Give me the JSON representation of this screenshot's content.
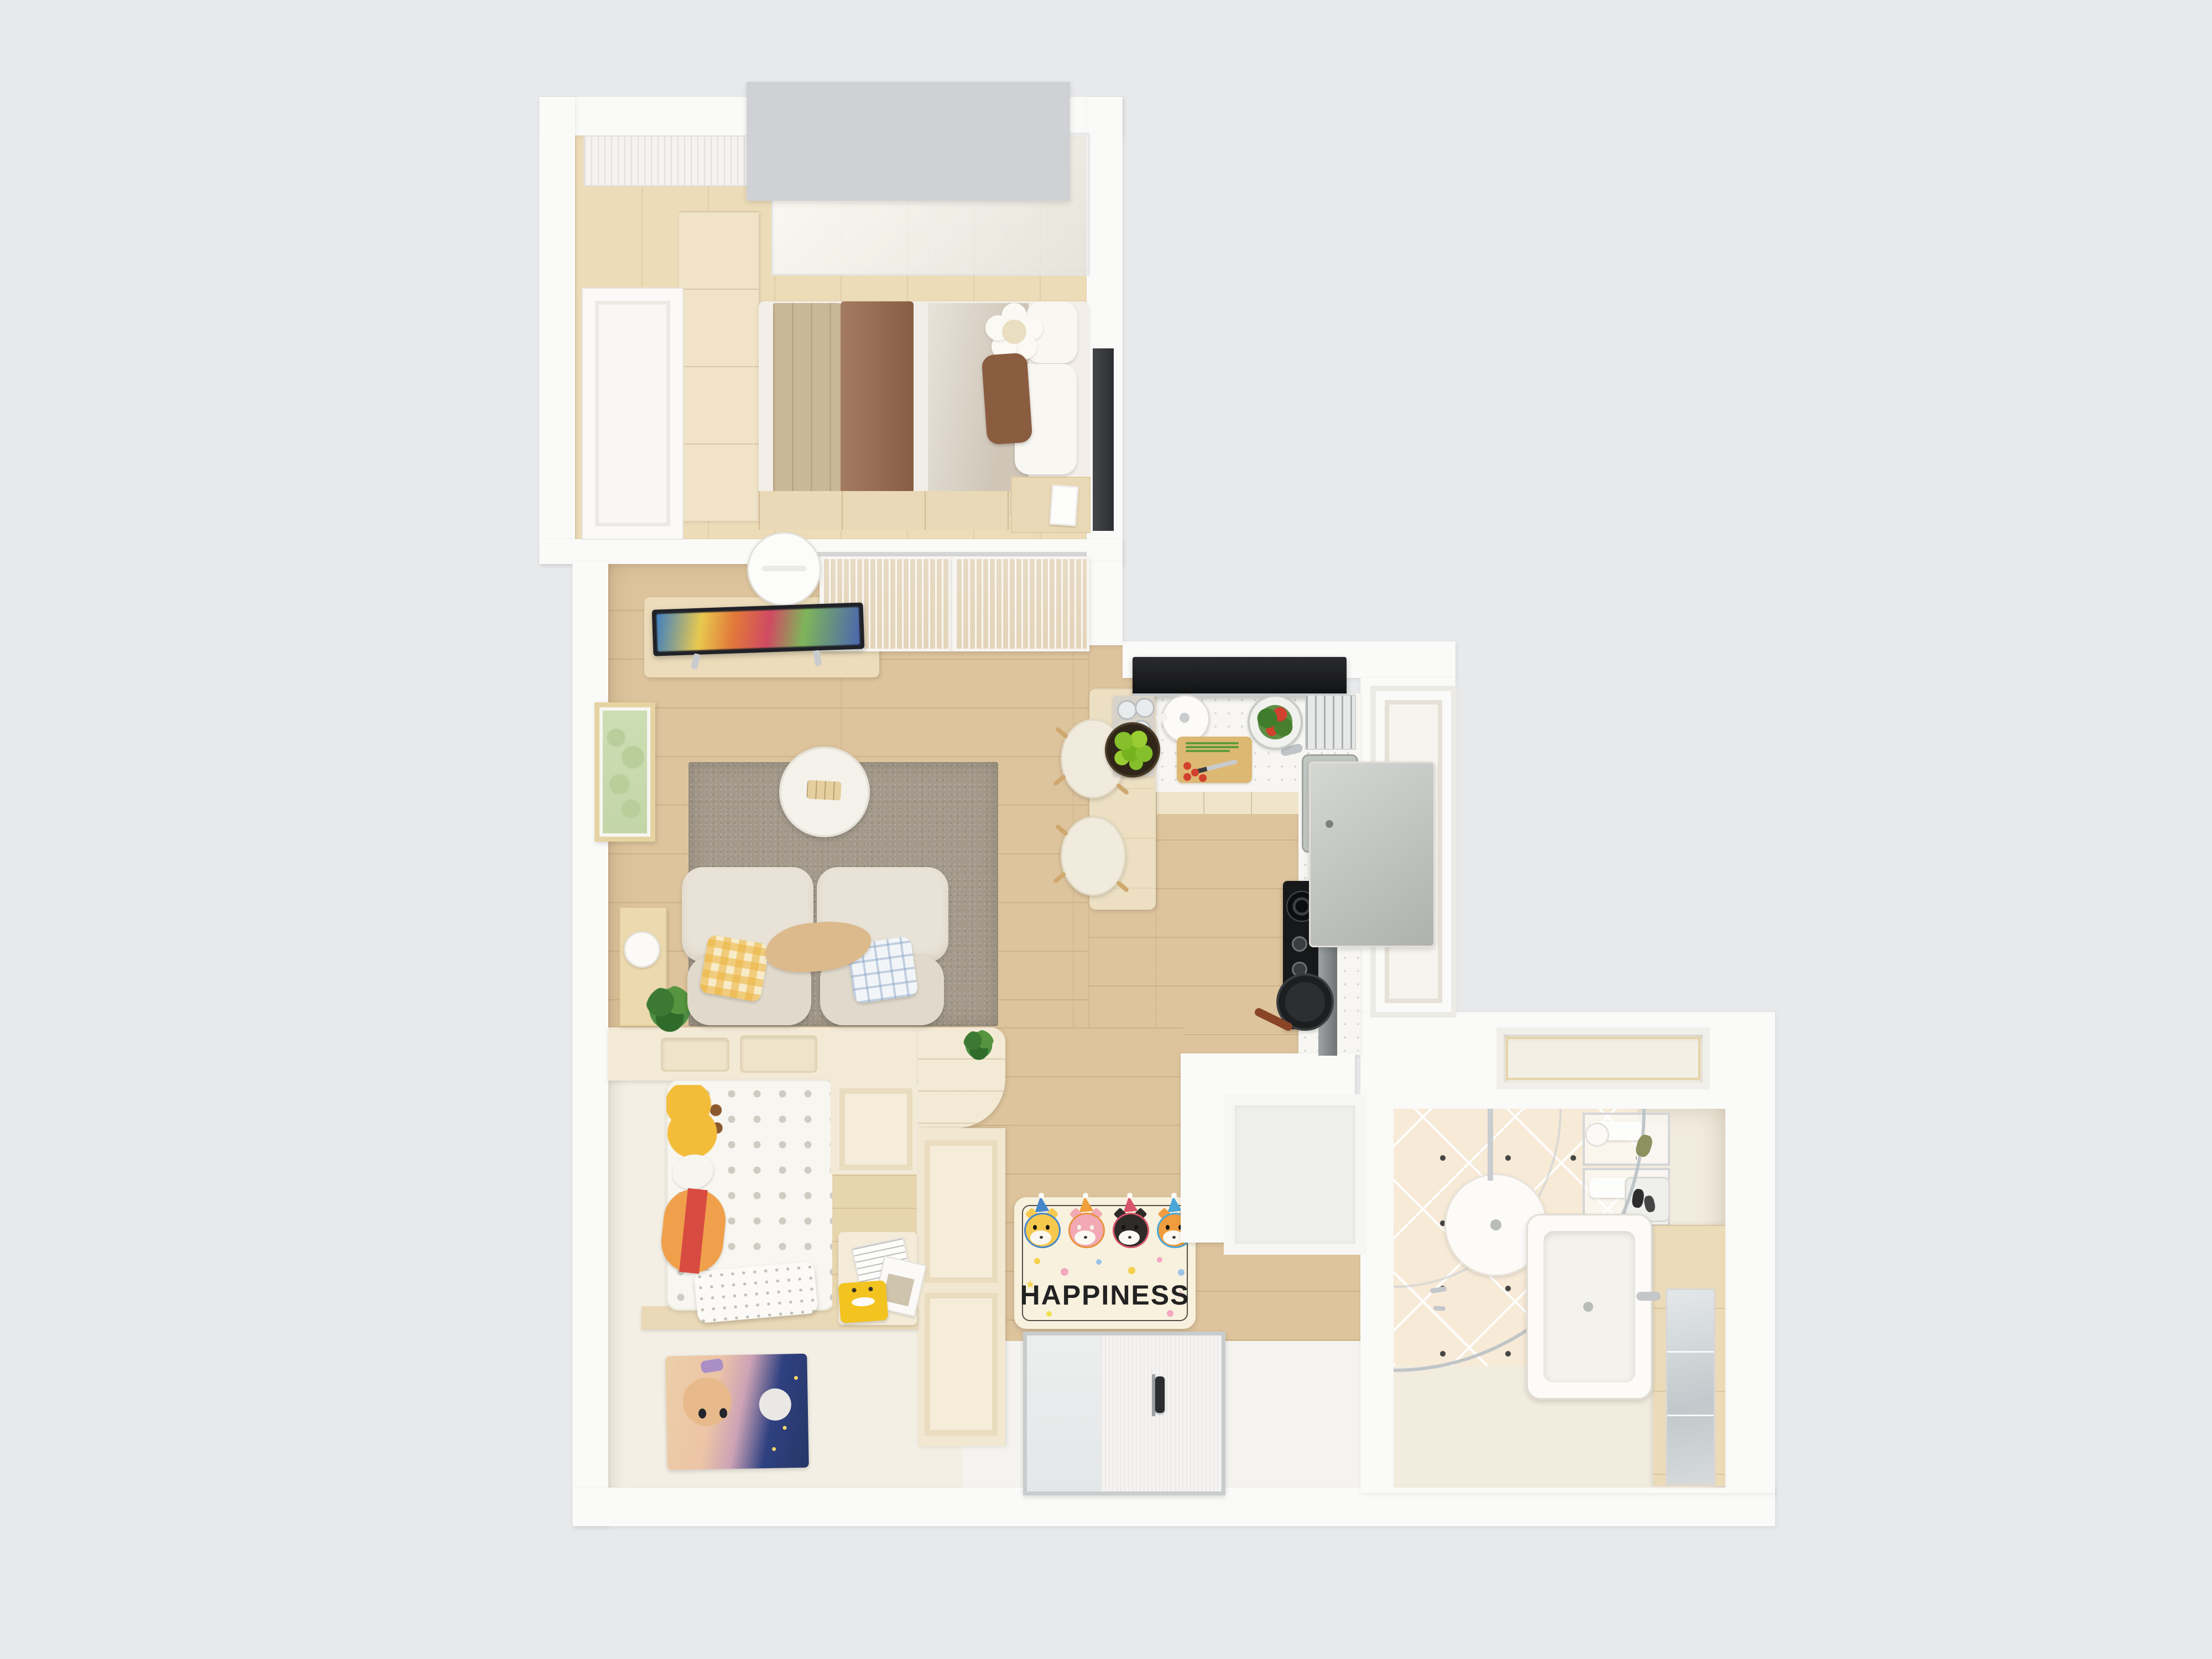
{
  "scene": {
    "type": "floorplan-render-top-view",
    "description": "3D top-down rendering of a small cream/beige apartment"
  },
  "mat": {
    "text": "HAPPINESS",
    "star_glyph": "★",
    "cats": [
      {
        "name": "yellow-cat-blue-hat",
        "body": "#f6c94e",
        "ring": "#4586c9",
        "hat": "#4586c9"
      },
      {
        "name": "pink-cat-orange-hat",
        "body": "#f2a9b4",
        "ring": "#e8923c",
        "hat": "#ef9f3c"
      },
      {
        "name": "black-cat-red-hat",
        "body": "#2f2b29",
        "ring": "#d8546a",
        "hat": "#d8546a"
      },
      {
        "name": "orange-cat-blue-hat",
        "body": "#f09d3f",
        "ring": "#49a7d8",
        "hat": "#49a7d8"
      }
    ],
    "confetti": [
      "#f5d04b",
      "#f3a8c0",
      "#9cc3e6",
      "#f5d04b",
      "#f3a8c0",
      "#9cc3e6",
      "#f0e24e",
      "#f3a8c0"
    ]
  },
  "palette": {
    "background": "#e8e9eb",
    "wall": "#fafaf8",
    "wood": "#ddc49d",
    "bedroom_wood": "#eddcb8",
    "kids_floor": "#f3efe5",
    "bath_floor": "#f2ecdf",
    "tile": "#f7ead7",
    "cream": "#f2e8d3",
    "lightwood": "#ead9b6",
    "counter": "#f7f6f2",
    "steel": "#c3c7c4",
    "black": "#17181a",
    "rug": "#a39a8b",
    "sofa": "#e9e3d7",
    "sofa_dark": "#e1dacc",
    "mat_cream": "#f8f1de",
    "ink": "#222222",
    "slab": "#d0d1d4",
    "green": "#4e8f43",
    "apple": "#85c02c",
    "tomato": "#d2402e",
    "p_yellow": "#f0c153",
    "p_blue": "#c3d4e6",
    "plush_yellow": "#f3bd3a",
    "hd_orange": "#f0a04b",
    "hd_red": "#d84b41",
    "tissue": "#f3c31f",
    "brown": "#97694b",
    "runner": "#c9b795",
    "duvet": "#dbd3c5",
    "board": "#ddb873",
    "star_yellow": "#f2d24b",
    "star_pink": "#efa9c4"
  },
  "rooms": [
    {
      "id": "bedroom",
      "items": [
        "double-bed",
        "white-pillows",
        "flower-pillow",
        "brown-lumbar-pillow",
        "brown-throw-blanket",
        "wardrobe",
        "room-door",
        "nightstand-with-photo",
        "ac-vent",
        "window-sheer-curtain",
        "wall-tv",
        "exterior-unit-slab"
      ]
    },
    {
      "id": "living-room",
      "items": [
        "tv-console",
        "flatscreen-tv",
        "ceiling-light",
        "sliding-fluted-glass-doors",
        "botanical-art-print",
        "wall-shelf-sconce",
        "potted-fern",
        "fabric-wall-panel",
        "round-coffee-table",
        "remote-control",
        "two-seat-sofa",
        "yellow-gingham-pillow",
        "blue-plaid-pillow",
        "squiggle-cushion"
      ]
    },
    {
      "id": "dining-nook",
      "items": [
        "wood-dining-bar",
        "two-cream-chairs",
        "serving-tray-with-glasses",
        "bowl-of-green-apples"
      ]
    },
    {
      "id": "kitchen",
      "items": [
        "range-hood",
        "terrazzo-counter",
        "white-kettle",
        "cutting-board-with-scallions-knife-tomatoes",
        "vegetable-bowl",
        "dish-rack",
        "stainless-sink",
        "gas-cooktop",
        "frying-pan",
        "gray-appliance",
        "tall-white-door",
        "peninsula-cabinet"
      ]
    },
    {
      "id": "kids-room",
      "items": [
        "kids-bed-dotted-mattress",
        "dotted-pillow",
        "yellow-plush",
        "egg-plush",
        "hotdog-plush",
        "bedside-cabinet",
        "side-table-with-magazines",
        "yellow-tissue-box",
        "illustrated-play-rug",
        "wardrobe-two-doors",
        "rounded-shelf-unit",
        "desk-with-trays"
      ]
    },
    {
      "id": "entry",
      "items": [
        "happiness-door-mat",
        "front-door",
        "door-handle"
      ]
    },
    {
      "id": "bathroom",
      "items": [
        "skylight-recess",
        "paw-print-tiles",
        "curved-glass-shower",
        "round-shower-base",
        "shower-pipe",
        "towel-racks",
        "toilet-paper-roll",
        "toiletry-basket",
        "white-basin",
        "faucet",
        "wood-vanity",
        "mirror-panel"
      ]
    }
  ]
}
